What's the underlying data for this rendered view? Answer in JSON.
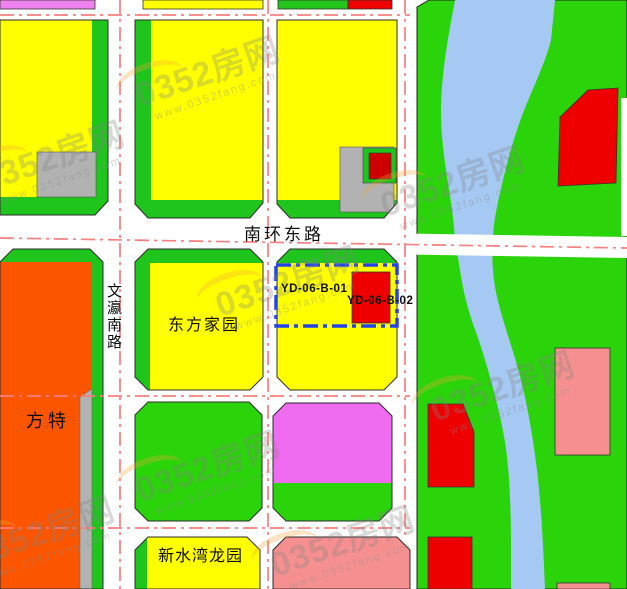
{
  "map": {
    "labels": {
      "road_nanhuan": "南环东路",
      "road_wenying": "文瀛南路",
      "block_dongfang": "东方家园",
      "parcel_yd01": "YD-06-B-01",
      "parcel_yd02": "YD-06-B-02",
      "block_fangte": "方特",
      "block_xinshuiwan": "新水湾龙园"
    },
    "watermark": {
      "text": "0352房网",
      "url": "www.0352fang.com"
    },
    "colors": {
      "residential_yellow": "#FFFF00",
      "green_space": "#2BD30B",
      "green_strip": "#1FC41C",
      "river_blue": "#A5C9F2",
      "red_block": "#EE0000",
      "orange_block": "#FB5500",
      "magenta_block": "#EF6BEF",
      "magenta_strip": "#EE82EE",
      "pink_block": "#F69090",
      "gray_block": "#B2B2B2",
      "road_white": "#FFFFFF",
      "road_centerline_red": "#F77F7F",
      "parcel_boundary_blue": "#2343E8"
    }
  }
}
